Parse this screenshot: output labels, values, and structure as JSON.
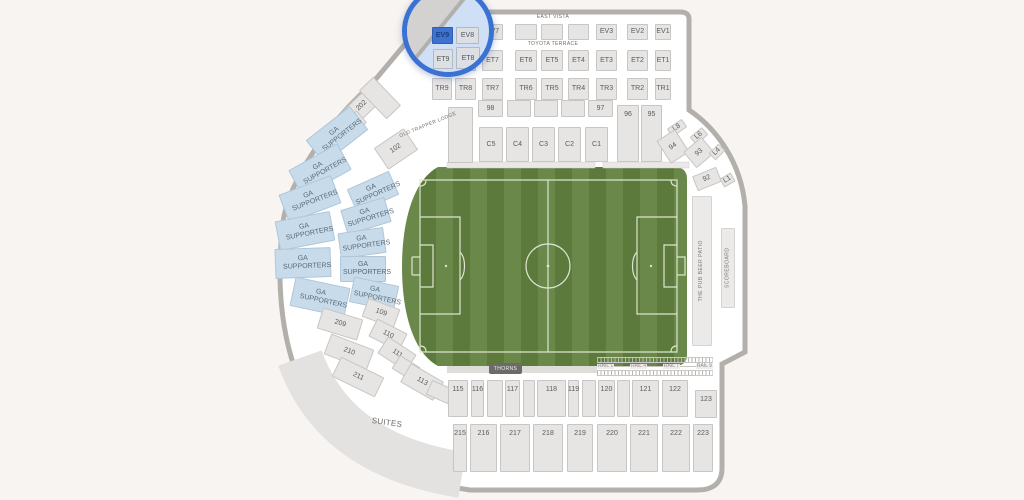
{
  "labels": {
    "east_vista": "EAST VISTA",
    "toyota_terrace": "TOYOTA TERRACE",
    "old_trapper_lodge": "OLD TRAPPER LODGE",
    "thorns": "THORNS",
    "suites": "SUITES",
    "rails": [
      "RAIL 1",
      "RAIL 4",
      "RAIL 7",
      "RAIL 9"
    ]
  },
  "magnifier": {
    "selected_section": "EV9",
    "sections": [
      "EV9",
      "EV8",
      "ET9",
      "ET8"
    ]
  },
  "colors": {
    "accent": "#3a72d3",
    "selected_fill": "#3d73d0",
    "ga_fill": "#c7dbea",
    "section_fill": "#e6e5e3",
    "field_green_light": "#6a8849",
    "field_green_dark": "#5d7a3d",
    "field_line": "#dce5cf",
    "wall": "#b3b0ac",
    "background": "#f7f4f1"
  },
  "grid": {
    "cols": [
      [
        432,
        20
      ],
      [
        455,
        21
      ],
      [
        482,
        21
      ],
      [
        515,
        22
      ],
      [
        541,
        22
      ],
      [
        568,
        21
      ],
      [
        596,
        21
      ],
      [
        627,
        21
      ],
      [
        655,
        16
      ]
    ],
    "rows": [
      {
        "y": 24,
        "h": 16,
        "labels": [
          "EV9",
          "EV8",
          "EV7",
          "",
          "",
          "",
          "EV3",
          "EV2",
          "EV1"
        ]
      },
      {
        "y": 50,
        "h": 21,
        "labels": [
          "ET9",
          "ET8",
          "ET7",
          "ET6",
          "ET5",
          "ET4",
          "ET3",
          "ET2",
          "ET1"
        ]
      },
      {
        "y": 78,
        "h": 22,
        "labels": [
          "TR9",
          "TR8",
          "TR7",
          "TR6",
          "TR5",
          "TR4",
          "TR3",
          "TR2",
          "TR1"
        ]
      }
    ]
  },
  "sections": [
    {
      "label": "98",
      "x": 478,
      "y": 100,
      "w": 25,
      "h": 17
    },
    {
      "label": "",
      "x": 507,
      "y": 100,
      "w": 24,
      "h": 17
    },
    {
      "label": "",
      "x": 534,
      "y": 100,
      "w": 24,
      "h": 17
    },
    {
      "label": "",
      "x": 561,
      "y": 100,
      "w": 24,
      "h": 17
    },
    {
      "label": "97",
      "x": 588,
      "y": 100,
      "w": 25,
      "h": 17
    },
    {
      "label": "",
      "x": 448,
      "y": 107,
      "w": 25,
      "h": 56
    },
    {
      "label": "96",
      "x": 617,
      "y": 105,
      "w": 22,
      "h": 57,
      "kind": "ta"
    },
    {
      "label": "95",
      "x": 641,
      "y": 105,
      "w": 21,
      "h": 57,
      "kind": "ta"
    },
    {
      "label": "C5",
      "x": 479,
      "y": 127,
      "w": 24,
      "h": 35
    },
    {
      "label": "C4",
      "x": 506,
      "y": 127,
      "w": 23,
      "h": 35
    },
    {
      "label": "C3",
      "x": 532,
      "y": 127,
      "w": 23,
      "h": 35
    },
    {
      "label": "C2",
      "x": 558,
      "y": 127,
      "w": 23,
      "h": 35
    },
    {
      "label": "C1",
      "x": 585,
      "y": 127,
      "w": 23,
      "h": 35
    },
    {
      "label": "L8",
      "x": 668,
      "y": 123,
      "w": 18,
      "h": 10,
      "rot": -35
    },
    {
      "label": "L6",
      "x": 691,
      "y": 131,
      "w": 16,
      "h": 10,
      "rot": -40
    },
    {
      "label": "94",
      "x": 662,
      "y": 133,
      "w": 22,
      "h": 27,
      "rot": -33
    },
    {
      "label": "93",
      "x": 687,
      "y": 142,
      "w": 24,
      "h": 21,
      "rot": -40
    },
    {
      "label": "L4",
      "x": 710,
      "y": 147,
      "w": 14,
      "h": 10,
      "rot": -45
    },
    {
      "label": "92",
      "x": 694,
      "y": 171,
      "w": 26,
      "h": 16,
      "rot": -22
    },
    {
      "label": "L1",
      "x": 721,
      "y": 175,
      "w": 13,
      "h": 10,
      "rot": -30
    },
    {
      "label": "202",
      "x": 342,
      "y": 96,
      "w": 40,
      "h": 20,
      "rot": -44
    },
    {
      "label": "",
      "x": 370,
      "y": 78,
      "w": 20,
      "h": 40,
      "rot": -44
    },
    {
      "label": "",
      "x": 330,
      "y": 120,
      "w": 36,
      "h": 16,
      "rot": -40
    },
    {
      "label": "102",
      "x": 378,
      "y": 136,
      "w": 36,
      "h": 26,
      "rot": -34
    },
    {
      "label": "GA SUPPORTERS",
      "x": 309,
      "y": 120,
      "w": 56,
      "h": 30,
      "rot": -38,
      "kind": "ga"
    },
    {
      "label": "GA SUPPORTERS",
      "x": 292,
      "y": 155,
      "w": 56,
      "h": 30,
      "rot": -29,
      "kind": "ga"
    },
    {
      "label": "GA SUPPORTERS",
      "x": 282,
      "y": 184,
      "w": 56,
      "h": 30,
      "rot": -21,
      "kind": "ga"
    },
    {
      "label": "GA SUPPORTERS",
      "x": 277,
      "y": 216,
      "w": 56,
      "h": 30,
      "rot": -11,
      "kind": "ga"
    },
    {
      "label": "GA SUPPORTERS",
      "x": 275,
      "y": 248,
      "w": 56,
      "h": 30,
      "rot": -2,
      "kind": "ga"
    },
    {
      "label": "GA SUPPORTERS",
      "x": 292,
      "y": 282,
      "w": 56,
      "h": 30,
      "rot": 12,
      "kind": "ga"
    },
    {
      "label": "GA SUPPORTERS",
      "x": 350,
      "y": 179,
      "w": 46,
      "h": 26,
      "rot": -24,
      "kind": "ga"
    },
    {
      "label": "GA SUPPORTERS",
      "x": 343,
      "y": 203,
      "w": 46,
      "h": 26,
      "rot": -17,
      "kind": "ga"
    },
    {
      "label": "GA SUPPORTERS",
      "x": 339,
      "y": 230,
      "w": 46,
      "h": 26,
      "rot": -8,
      "kind": "ga"
    },
    {
      "label": "GA SUPPORTERS",
      "x": 340,
      "y": 256,
      "w": 46,
      "h": 26,
      "rot": 0,
      "kind": "ga"
    },
    {
      "label": "GA SUPPORTERS",
      "x": 351,
      "y": 281,
      "w": 46,
      "h": 26,
      "rot": 12,
      "kind": "ga"
    },
    {
      "label": "209",
      "x": 319,
      "y": 313,
      "w": 42,
      "h": 22,
      "rot": 17
    },
    {
      "label": "109",
      "x": 364,
      "y": 303,
      "w": 34,
      "h": 20,
      "rot": 20
    },
    {
      "label": "110",
      "x": 371,
      "y": 325,
      "w": 34,
      "h": 20,
      "rot": 27
    },
    {
      "label": "210",
      "x": 326,
      "y": 341,
      "w": 46,
      "h": 22,
      "rot": 21
    },
    {
      "label": "111",
      "x": 380,
      "y": 344,
      "w": 34,
      "h": 20,
      "rot": 33
    },
    {
      "label": "211",
      "x": 334,
      "y": 366,
      "w": 48,
      "h": 22,
      "rot": 26
    },
    {
      "label": "",
      "x": 394,
      "y": 360,
      "w": 24,
      "h": 16,
      "rot": 32
    },
    {
      "label": "113",
      "x": 403,
      "y": 371,
      "w": 38,
      "h": 22,
      "rot": 30
    },
    {
      "label": "",
      "x": 428,
      "y": 384,
      "w": 24,
      "h": 16,
      "rot": 24
    },
    {
      "label": "115",
      "x": 448,
      "y": 380,
      "w": 20,
      "h": 37,
      "kind": "ta"
    },
    {
      "label": "116",
      "x": 471,
      "y": 380,
      "w": 13,
      "h": 37,
      "kind": "ta"
    },
    {
      "label": "",
      "x": 487,
      "y": 380,
      "w": 16,
      "h": 37,
      "kind": "ta"
    },
    {
      "label": "117",
      "x": 505,
      "y": 380,
      "w": 15,
      "h": 37,
      "kind": "ta"
    },
    {
      "label": "",
      "x": 523,
      "y": 380,
      "w": 12,
      "h": 37,
      "kind": "ta"
    },
    {
      "label": "118",
      "x": 537,
      "y": 380,
      "w": 29,
      "h": 37,
      "kind": "ta"
    },
    {
      "label": "119",
      "x": 568,
      "y": 380,
      "w": 11,
      "h": 37,
      "kind": "ta"
    },
    {
      "label": "",
      "x": 582,
      "y": 380,
      "w": 14,
      "h": 37,
      "kind": "ta"
    },
    {
      "label": "120",
      "x": 598,
      "y": 380,
      "w": 17,
      "h": 37,
      "kind": "ta"
    },
    {
      "label": "",
      "x": 617,
      "y": 380,
      "w": 13,
      "h": 37,
      "kind": "ta"
    },
    {
      "label": "121",
      "x": 632,
      "y": 380,
      "w": 27,
      "h": 37,
      "kind": "ta"
    },
    {
      "label": "122",
      "x": 662,
      "y": 380,
      "w": 26,
      "h": 37,
      "kind": "ta"
    },
    {
      "label": "123",
      "x": 695,
      "y": 390,
      "w": 22,
      "h": 28,
      "kind": "ta"
    },
    {
      "label": "215",
      "x": 453,
      "y": 424,
      "w": 14,
      "h": 48,
      "kind": "ta"
    },
    {
      "label": "216",
      "x": 470,
      "y": 424,
      "w": 27,
      "h": 48,
      "kind": "ta"
    },
    {
      "label": "217",
      "x": 500,
      "y": 424,
      "w": 30,
      "h": 48,
      "kind": "ta"
    },
    {
      "label": "218",
      "x": 533,
      "y": 424,
      "w": 30,
      "h": 48,
      "kind": "ta"
    },
    {
      "label": "219",
      "x": 567,
      "y": 424,
      "w": 26,
      "h": 48,
      "kind": "ta"
    },
    {
      "label": "220",
      "x": 597,
      "y": 424,
      "w": 30,
      "h": 48,
      "kind": "ta"
    },
    {
      "label": "221",
      "x": 630,
      "y": 424,
      "w": 28,
      "h": 48,
      "kind": "ta"
    },
    {
      "label": "222",
      "x": 662,
      "y": 424,
      "w": 28,
      "h": 48,
      "kind": "ta"
    },
    {
      "label": "223",
      "x": 693,
      "y": 424,
      "w": 20,
      "h": 48,
      "kind": "ta"
    },
    {
      "label": "THE PUB BEER PATIO",
      "x": 692,
      "y": 196,
      "w": 20,
      "h": 150,
      "kind": "vert"
    },
    {
      "label": "SCOREBOARD",
      "x": 721,
      "y": 228,
      "w": 14,
      "h": 80,
      "kind": "vert"
    }
  ]
}
